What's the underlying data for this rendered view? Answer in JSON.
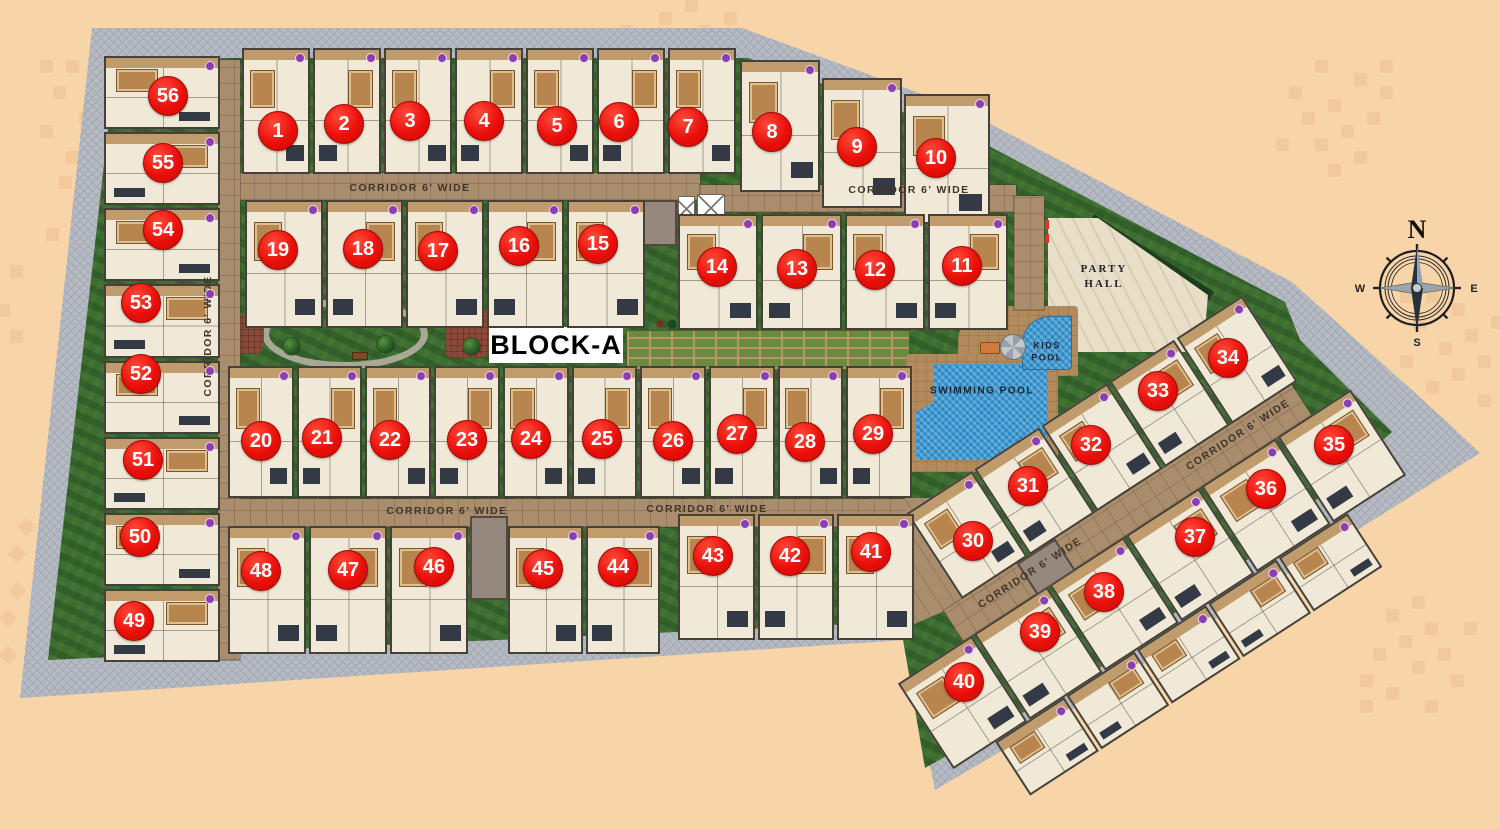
{
  "scene": {
    "block_label": "BLOCK-A",
    "party_hall_line1": "PARTY",
    "party_hall_line2": "HALL",
    "swimming_pool_label": "SWIMMING POOL",
    "kids_pool_line1": "KIDS",
    "kids_pool_line2": "POOL",
    "corridor_label": "CORRIDOR 6' WIDE",
    "compass": {
      "north": "N",
      "east": "E",
      "south": "S",
      "west": "W"
    }
  },
  "colors": {
    "background": "#f8d5a9",
    "boundary_gray": "#b6bac2",
    "lawn_green": "#3c6e32",
    "corridor_tan": "#a98d6d",
    "unit_cream": "#f0e9d7",
    "unit_wall": "#45413a",
    "marker_red": "#ea0f0a",
    "pool_blue": "#3d9bd4",
    "marble_cream": "#e9dfc9",
    "deck_tan": "#b28a5c",
    "unit_dot_purple": "#8b3fae"
  },
  "corridor_labels": [
    {
      "x": 410,
      "y": 188,
      "rot": 0
    },
    {
      "x": 909,
      "y": 190,
      "rot": 0
    },
    {
      "x": 208,
      "y": 336,
      "rot": -90
    },
    {
      "x": 447,
      "y": 511,
      "rot": 0
    },
    {
      "x": 707,
      "y": 509,
      "rot": 0
    },
    {
      "x": 1238,
      "y": 435,
      "rot": -33
    },
    {
      "x": 1030,
      "y": 573,
      "rot": -33
    }
  ],
  "unit_markers": [
    {
      "n": 1,
      "x": 278,
      "y": 131
    },
    {
      "n": 2,
      "x": 344,
      "y": 124
    },
    {
      "n": 3,
      "x": 410,
      "y": 121
    },
    {
      "n": 4,
      "x": 484,
      "y": 121
    },
    {
      "n": 5,
      "x": 557,
      "y": 126
    },
    {
      "n": 6,
      "x": 619,
      "y": 122
    },
    {
      "n": 7,
      "x": 688,
      "y": 127
    },
    {
      "n": 8,
      "x": 772,
      "y": 132
    },
    {
      "n": 9,
      "x": 857,
      "y": 147
    },
    {
      "n": 10,
      "x": 936,
      "y": 158
    },
    {
      "n": 11,
      "x": 962,
      "y": 266
    },
    {
      "n": 12,
      "x": 875,
      "y": 270
    },
    {
      "n": 13,
      "x": 797,
      "y": 269
    },
    {
      "n": 14,
      "x": 717,
      "y": 267
    },
    {
      "n": 15,
      "x": 598,
      "y": 244
    },
    {
      "n": 16,
      "x": 519,
      "y": 246
    },
    {
      "n": 17,
      "x": 438,
      "y": 251
    },
    {
      "n": 18,
      "x": 363,
      "y": 249
    },
    {
      "n": 19,
      "x": 278,
      "y": 250
    },
    {
      "n": 20,
      "x": 261,
      "y": 441
    },
    {
      "n": 21,
      "x": 322,
      "y": 438
    },
    {
      "n": 22,
      "x": 390,
      "y": 440
    },
    {
      "n": 23,
      "x": 467,
      "y": 440
    },
    {
      "n": 24,
      "x": 531,
      "y": 439
    },
    {
      "n": 25,
      "x": 602,
      "y": 439
    },
    {
      "n": 26,
      "x": 673,
      "y": 441
    },
    {
      "n": 27,
      "x": 737,
      "y": 434
    },
    {
      "n": 28,
      "x": 805,
      "y": 442
    },
    {
      "n": 29,
      "x": 873,
      "y": 434
    },
    {
      "n": 30,
      "x": 973,
      "y": 541
    },
    {
      "n": 31,
      "x": 1028,
      "y": 486
    },
    {
      "n": 32,
      "x": 1091,
      "y": 445
    },
    {
      "n": 33,
      "x": 1158,
      "y": 391
    },
    {
      "n": 34,
      "x": 1228,
      "y": 358
    },
    {
      "n": 35,
      "x": 1334,
      "y": 445
    },
    {
      "n": 36,
      "x": 1266,
      "y": 489
    },
    {
      "n": 37,
      "x": 1195,
      "y": 537
    },
    {
      "n": 38,
      "x": 1104,
      "y": 592
    },
    {
      "n": 39,
      "x": 1040,
      "y": 632
    },
    {
      "n": 40,
      "x": 964,
      "y": 682
    },
    {
      "n": 41,
      "x": 871,
      "y": 552
    },
    {
      "n": 42,
      "x": 790,
      "y": 556
    },
    {
      "n": 43,
      "x": 713,
      "y": 556
    },
    {
      "n": 44,
      "x": 618,
      "y": 567
    },
    {
      "n": 45,
      "x": 543,
      "y": 569
    },
    {
      "n": 46,
      "x": 434,
      "y": 567
    },
    {
      "n": 47,
      "x": 348,
      "y": 570
    },
    {
      "n": 48,
      "x": 261,
      "y": 571
    },
    {
      "n": 49,
      "x": 134,
      "y": 621
    },
    {
      "n": 50,
      "x": 140,
      "y": 537
    },
    {
      "n": 51,
      "x": 143,
      "y": 460
    },
    {
      "n": 52,
      "x": 141,
      "y": 374
    },
    {
      "n": 53,
      "x": 141,
      "y": 303
    },
    {
      "n": 54,
      "x": 163,
      "y": 230
    },
    {
      "n": 55,
      "x": 163,
      "y": 163
    },
    {
      "n": 56,
      "x": 168,
      "y": 96
    }
  ],
  "unit_rows": {
    "main": [
      {
        "x": 242,
        "y": 48,
        "w": 494,
        "h": 126,
        "cells": 7
      },
      {
        "x": 740,
        "y": 60,
        "w": 80,
        "h": 132,
        "cells": 1
      },
      {
        "x": 822,
        "y": 78,
        "w": 80,
        "h": 130,
        "cells": 1
      },
      {
        "x": 904,
        "y": 94,
        "w": 86,
        "h": 130,
        "cells": 1
      },
      {
        "x": 245,
        "y": 200,
        "w": 400,
        "h": 128,
        "cells": 5
      },
      {
        "x": 678,
        "y": 214,
        "w": 330,
        "h": 116,
        "cells": 4
      },
      {
        "x": 228,
        "y": 366,
        "w": 684,
        "h": 132,
        "cells": 10
      },
      {
        "x": 228,
        "y": 526,
        "w": 240,
        "h": 128,
        "cells": 3
      },
      {
        "x": 508,
        "y": 526,
        "w": 152,
        "h": 128,
        "cells": 2
      },
      {
        "x": 678,
        "y": 514,
        "w": 236,
        "h": 126,
        "cells": 3
      },
      {
        "x": 104,
        "y": 56,
        "w": 116,
        "h": 606,
        "cells": 8,
        "vertical": true
      }
    ],
    "wing": [
      {
        "x": 140,
        "y": 2,
        "w": 400,
        "h": 102,
        "cells": 5
      },
      {
        "x": 40,
        "y": 140,
        "w": 540,
        "h": 102,
        "cells": 6
      },
      {
        "x": 90,
        "y": 242,
        "w": 420,
        "h": 64,
        "cells": 5
      }
    ]
  }
}
